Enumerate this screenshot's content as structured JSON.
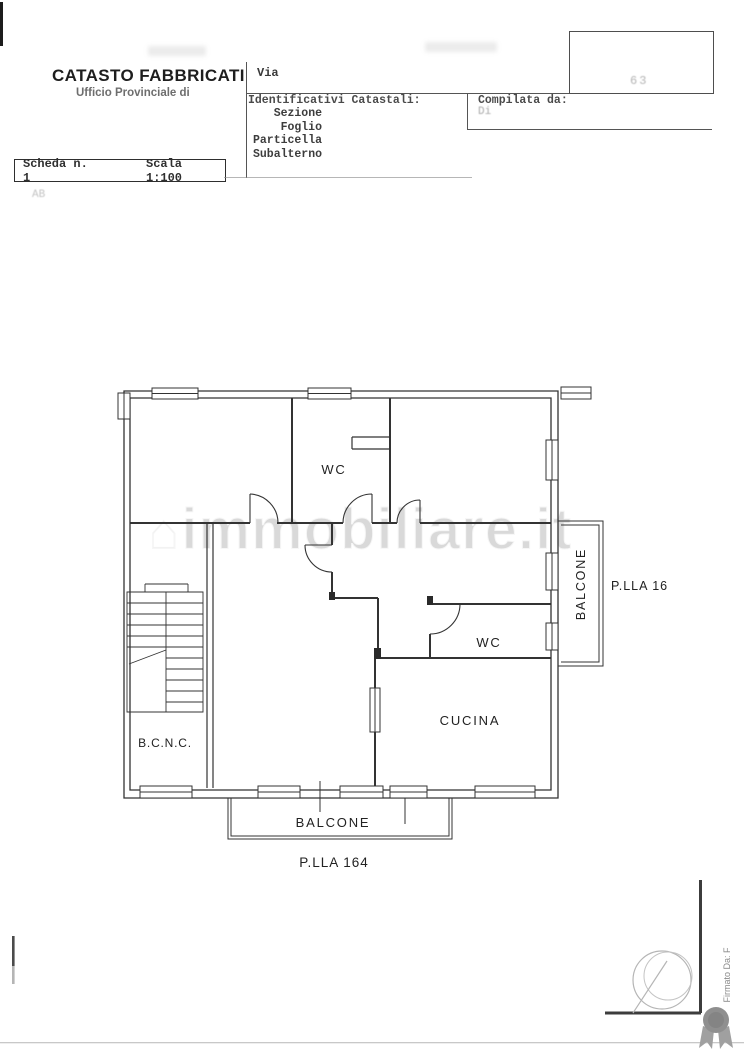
{
  "header": {
    "title": "CATASTO FABBRICATI",
    "subtitle": "Ufficio Provinciale di",
    "scheda_label": "Scheda n. 1",
    "scala_label": "Scala 1:100",
    "via_label": "Via",
    "identificativi_heading": "Identificativi Catastali:",
    "identificativi_rows": [
      "Sezione",
      "Foglio",
      "Particella",
      "Subalterno"
    ],
    "compilata_heading": "Compilata da:",
    "compilata_subline": "Di",
    "faint_number": "63",
    "faded_note": "AB"
  },
  "plan": {
    "rooms": {
      "wc_top": "WC",
      "wc_mid": "WC",
      "cucina": "CUCINA",
      "bcnc": "B.C.N.C.",
      "balcone_bottom": "BALCONE",
      "balcone_right": "BALCONE"
    },
    "parcels": {
      "bottom": "P.LLA 164",
      "right": "P.LLA 16"
    }
  },
  "watermark": {
    "text": "immobiliare.it"
  },
  "footer": {
    "signature": "Firmato Da: F"
  },
  "colors": {
    "ink": "#2f2f2f",
    "paper": "#ffffff",
    "watermark_gray": "#8c8c8c",
    "stamp_gray": "#b5b5b5",
    "seal_gray": "#8f8f8f"
  }
}
